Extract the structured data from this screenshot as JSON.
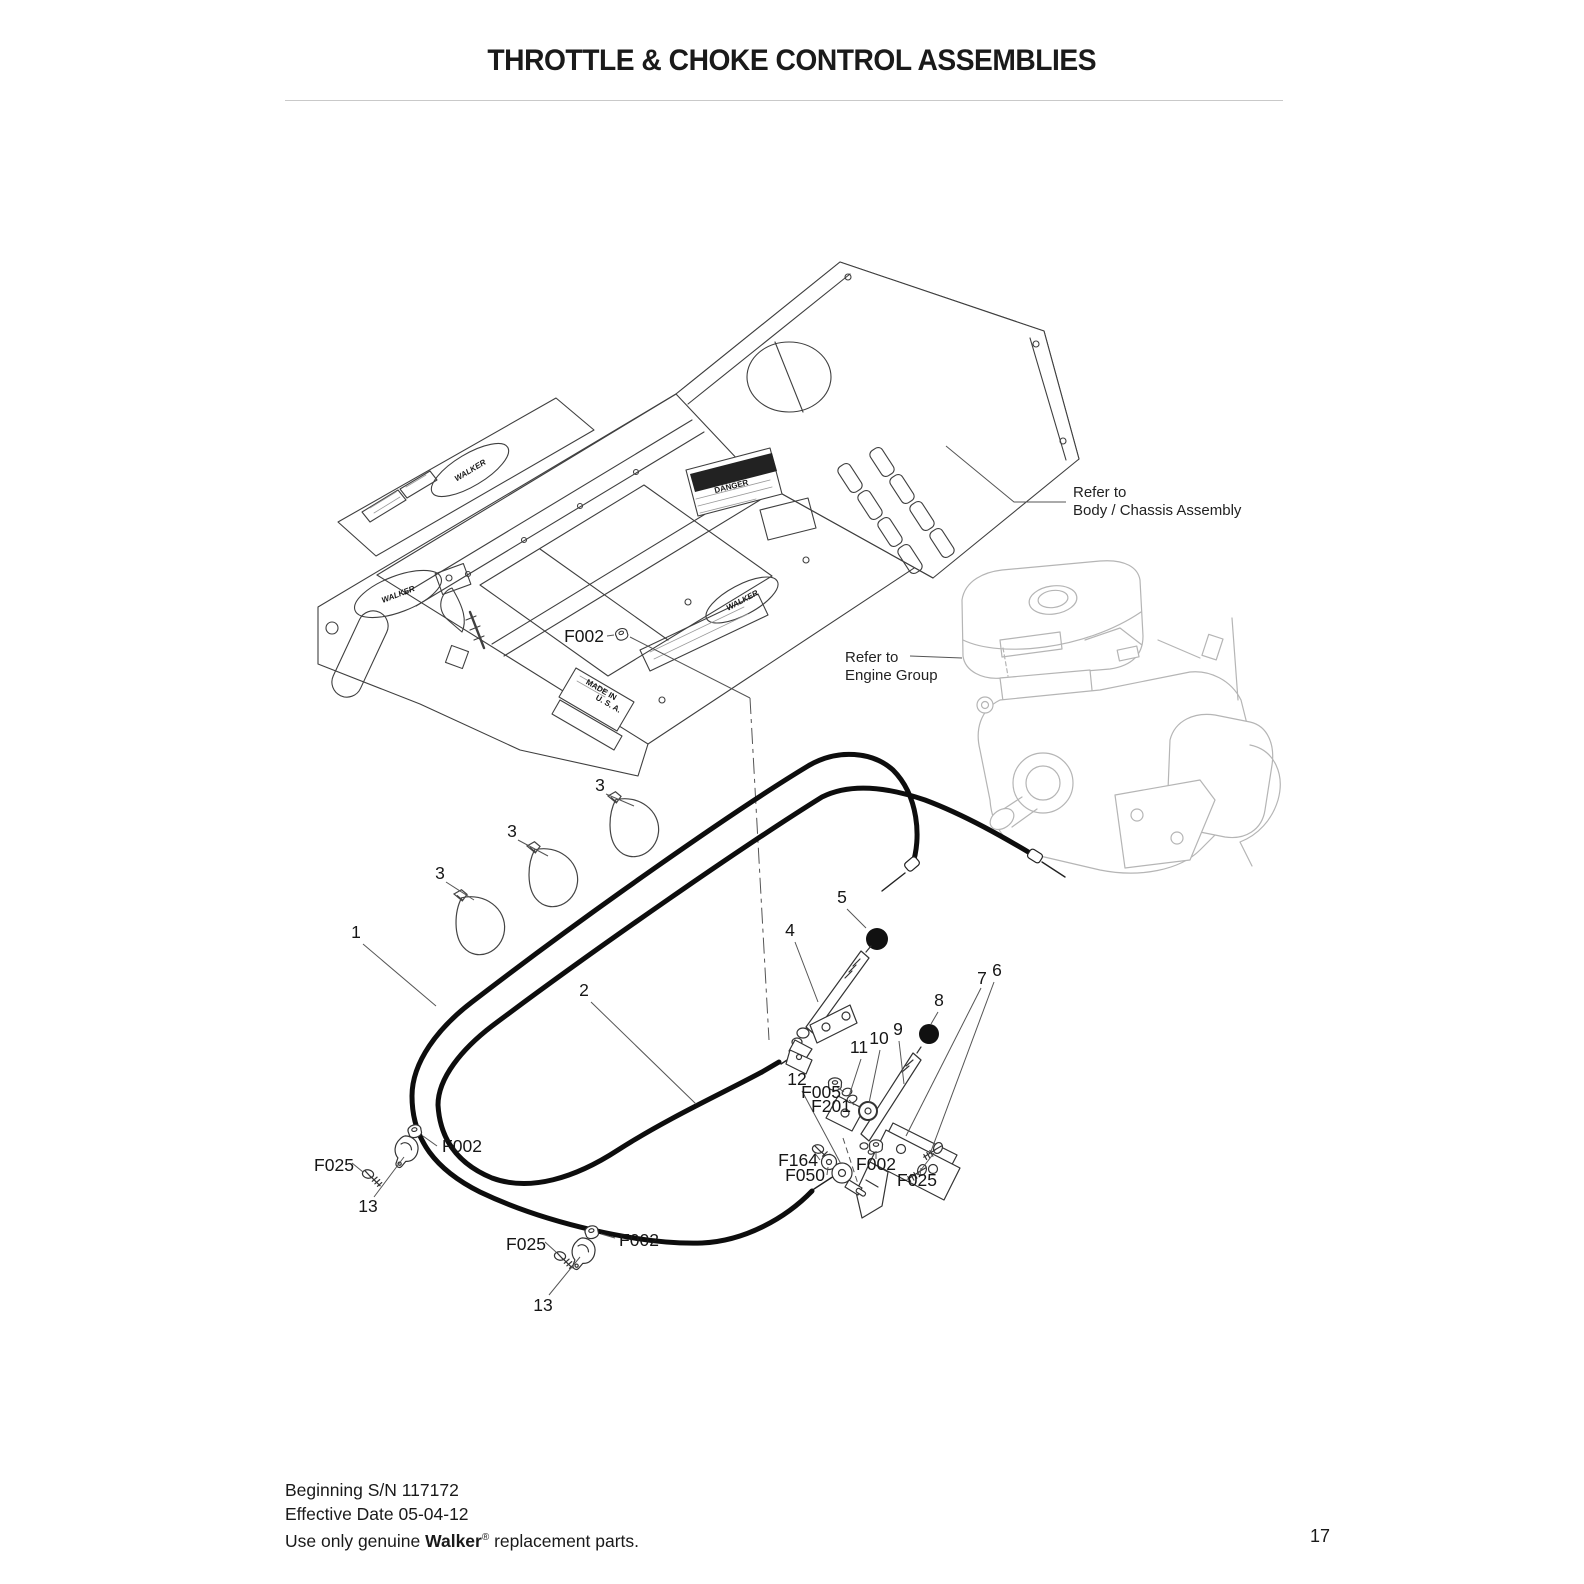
{
  "page": {
    "title": "THROTTLE & CHOKE CONTROL ASSEMBLIES",
    "page_number": "17",
    "footer": {
      "line1": "Beginning S/N 117172",
      "line2": "Effective Date 05-04-12",
      "line3_prefix": "Use only genuine ",
      "line3_brand": "Walker",
      "line3_reg": "®",
      "line3_suffix": " replacement parts."
    }
  },
  "diagram": {
    "notes": {
      "refer_body": {
        "line1": "Refer to",
        "line2": "Body / Chassis Assembly"
      },
      "refer_engine": {
        "line1": "Refer to",
        "line2": "Engine Group"
      }
    },
    "part_labels": [
      {
        "id": "f002-body-washer",
        "text": "F002"
      },
      {
        "id": "cable-tie-upper",
        "text": "3"
      },
      {
        "id": "cable-tie-middle",
        "text": "3"
      },
      {
        "id": "cable-tie-lower",
        "text": "3"
      },
      {
        "id": "choke-cable",
        "text": "1"
      },
      {
        "id": "throttle-cable",
        "text": "2"
      },
      {
        "id": "throttle-lever",
        "text": "4"
      },
      {
        "id": "throttle-knob",
        "text": "5"
      },
      {
        "id": "bracket-plate-6",
        "text": "6"
      },
      {
        "id": "bracket-plate-7",
        "text": "7"
      },
      {
        "id": "choke-knob",
        "text": "8"
      },
      {
        "id": "choke-lever",
        "text": "9"
      },
      {
        "id": "washer-10",
        "text": "10"
      },
      {
        "id": "plate-11",
        "text": "11"
      },
      {
        "id": "swivel-12",
        "text": "12"
      },
      {
        "id": "f005-nut",
        "text": "F005"
      },
      {
        "id": "f201-washer",
        "text": "F201"
      },
      {
        "id": "f164-screw",
        "text": "F164"
      },
      {
        "id": "f050-washer",
        "text": "F050"
      },
      {
        "id": "f002-right",
        "text": "F002"
      },
      {
        "id": "f025-right",
        "text": "F025"
      },
      {
        "id": "f002-left-1",
        "text": "F002"
      },
      {
        "id": "f025-left-1",
        "text": "F025"
      },
      {
        "id": "clamp-13-first",
        "text": "13"
      },
      {
        "id": "f002-left-2",
        "text": "F002"
      },
      {
        "id": "f025-left-2",
        "text": "F025"
      },
      {
        "id": "clamp-13-second",
        "text": "13"
      }
    ],
    "body_art": {
      "walker": "WALKER",
      "danger": "DANGER",
      "made_in": "MADE IN",
      "usa": "U. S. A."
    }
  }
}
